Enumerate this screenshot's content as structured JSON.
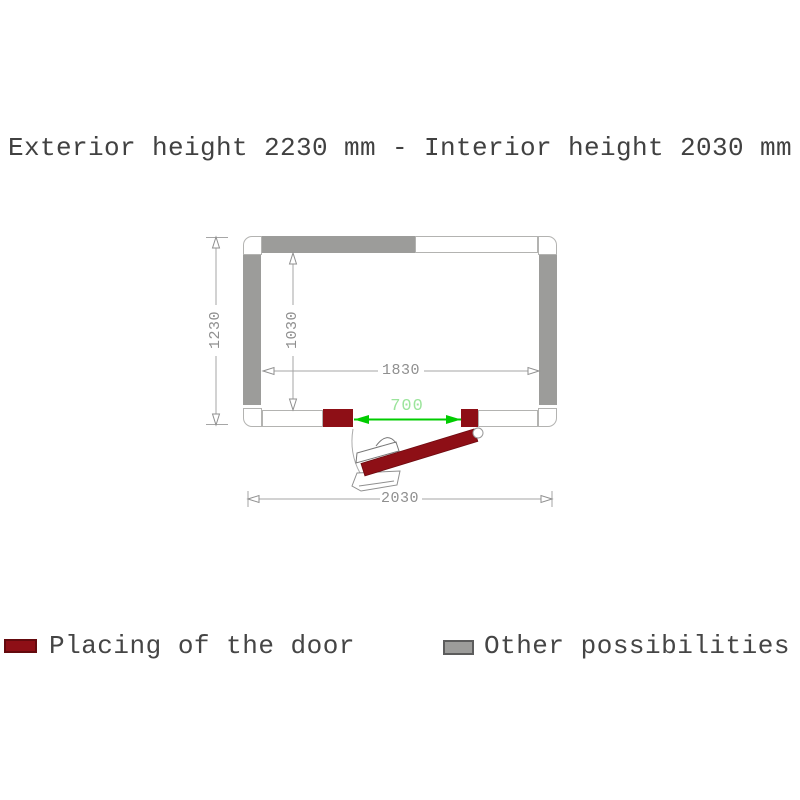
{
  "title": "Exterior height 2230 mm - Interior height 2030 mm",
  "plan": {
    "dimensions": {
      "exterior_depth": "1230",
      "interior_depth": "1030",
      "interior_width": "1830",
      "exterior_width": "2030",
      "door_width": "700"
    },
    "colors": {
      "wall_gray": "#9c9c9a",
      "door_red": "#8e0f16",
      "dim_green": "#00cc00",
      "dim_green_text": "#9be49b",
      "dim_gray": "#8f8f8f"
    }
  },
  "legend": {
    "door": {
      "label": "Placing of the door",
      "color": "#8e0f16"
    },
    "other": {
      "label": "Other possibilities",
      "color": "#9c9c9a"
    }
  }
}
